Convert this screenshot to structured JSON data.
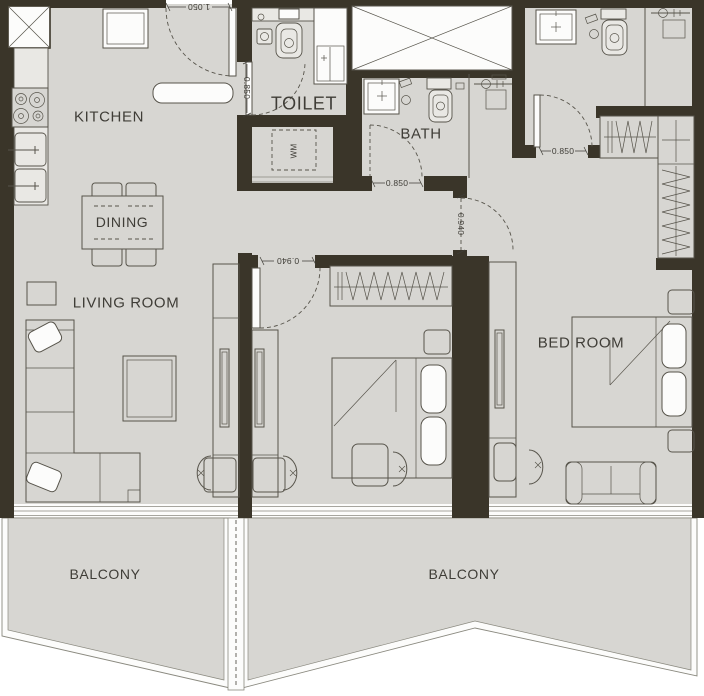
{
  "plan": {
    "rooms": {
      "kitchen": "KITCHEN",
      "toilet": "TOILET",
      "bath": "BATH",
      "dining": "DINING",
      "living_room": "LIVING ROOM",
      "bedroom": "BED ROOM",
      "balcony_left": "BALCONY",
      "balcony_right": "BALCONY",
      "washing_machine": "WM"
    },
    "dimensions": {
      "entrance_door": "1.050",
      "toilet_door": "0.850",
      "bath_door": "0.850",
      "ensuite_door": "0.850",
      "bedroom1_door": "0.940",
      "bedroom2_door": "0.940"
    },
    "colors": {
      "wall": "#3a3529",
      "floor": "#d7d6d2",
      "outline": "#57544b",
      "fixture": "#fcfcfb",
      "ink": "#3f3d37"
    }
  }
}
